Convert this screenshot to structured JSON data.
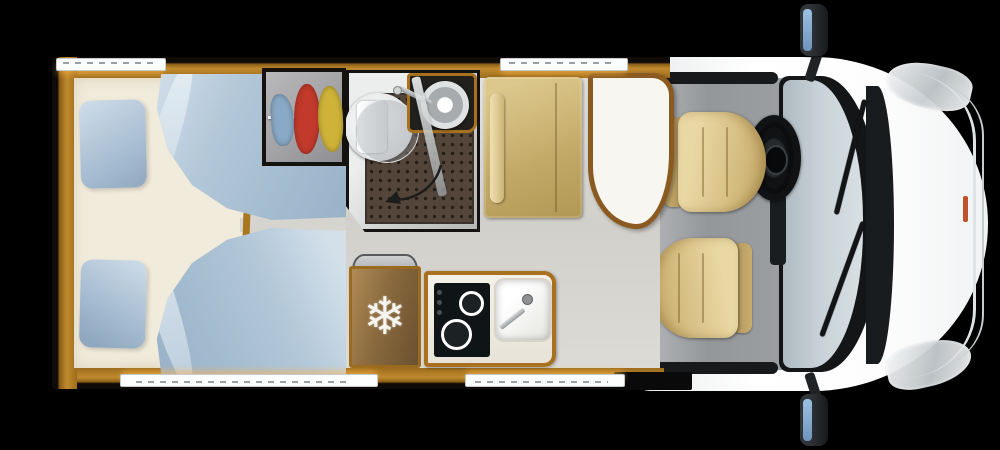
{
  "icons": {
    "fridge_snowflake": "❄"
  },
  "floorplan": {
    "view": "top-down",
    "vehicle_front": "right",
    "background": "#000000",
    "areas": [
      {
        "name": "twin-bedroom",
        "items": [
          "bed-top",
          "bed-bottom",
          "pillow-top",
          "pillow-bottom",
          "duvet-top",
          "duvet-bottom",
          "center-step"
        ]
      },
      {
        "name": "wardrobe",
        "items": [
          "hanging-rail",
          "clothes-blue",
          "clothes-red",
          "clothes-yellow"
        ]
      },
      {
        "name": "bathroom",
        "items": [
          "toilet",
          "washbasin",
          "faucet",
          "shower-floor",
          "shower-door",
          "door-swing-arrow"
        ]
      },
      {
        "name": "dinette",
        "items": [
          "bench-seat",
          "armrest",
          "table"
        ]
      },
      {
        "name": "kitchen",
        "items": [
          "refrigerator",
          "fridge-snowflake-icon",
          "two-burner-hob",
          "sink",
          "faucet"
        ]
      },
      {
        "name": "cab",
        "items": [
          "driver-seat",
          "passenger-seat",
          "steering-wheel",
          "windshield",
          "wiper-left",
          "wiper-right",
          "side-mirror-top",
          "side-mirror-bottom",
          "headlight-top",
          "headlight-bottom"
        ]
      }
    ],
    "windows": [
      "top-rear",
      "top-front",
      "bottom-rear",
      "bottom-front-door"
    ],
    "colors": {
      "wood_trim": "#a8701f",
      "wall_wood": "#8a5c12",
      "floor_gray": "#d6d4cf",
      "mattress_cream": "#f1ebdb",
      "bedding_blue": "#aec4d8",
      "upholstery_tan": "#d2ba7d",
      "cab_body_white": "#f7f9fa",
      "windshield_glass": "#c7d1d7",
      "shower_tile_brown": "#53453a",
      "hob_black": "#0f1417",
      "mirror_glass_blue": "#8fb4d4",
      "clothes": [
        "#8aa9c6",
        "#c23a2b",
        "#cfb339"
      ]
    }
  }
}
